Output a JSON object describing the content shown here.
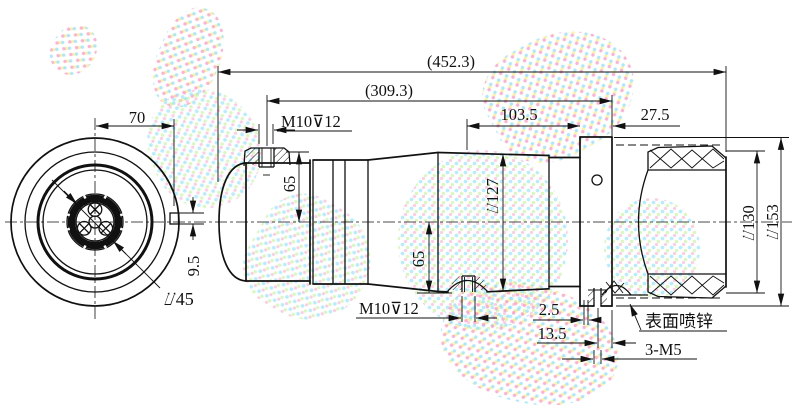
{
  "drawing_type": "engineering-dimension-drawing",
  "colors": {
    "line": "#111111",
    "background": "#ffffff",
    "watermark_pink": "#ff96c8",
    "watermark_cyan": "#8ce1ff",
    "watermark_yellow": "#fff08c",
    "watermark_green": "#c8f5a0"
  },
  "dims": {
    "overall": "(452.3)",
    "body": "(309.3)",
    "pos103": "103.5",
    "pos27": "27.5",
    "front70": "70",
    "tab95": "9.5",
    "hub45": "⌰45",
    "thread_top": "M10⊽12",
    "thread_bottom": "M10⊽12",
    "r65top": "65",
    "r65bot": "65",
    "d127": "⌰127",
    "d130": "⌰130",
    "d153": "⌰153",
    "pos25": "2.5",
    "pos135": "13.5",
    "m5": "3-M5",
    "note_zinc": "表面喷锌"
  }
}
